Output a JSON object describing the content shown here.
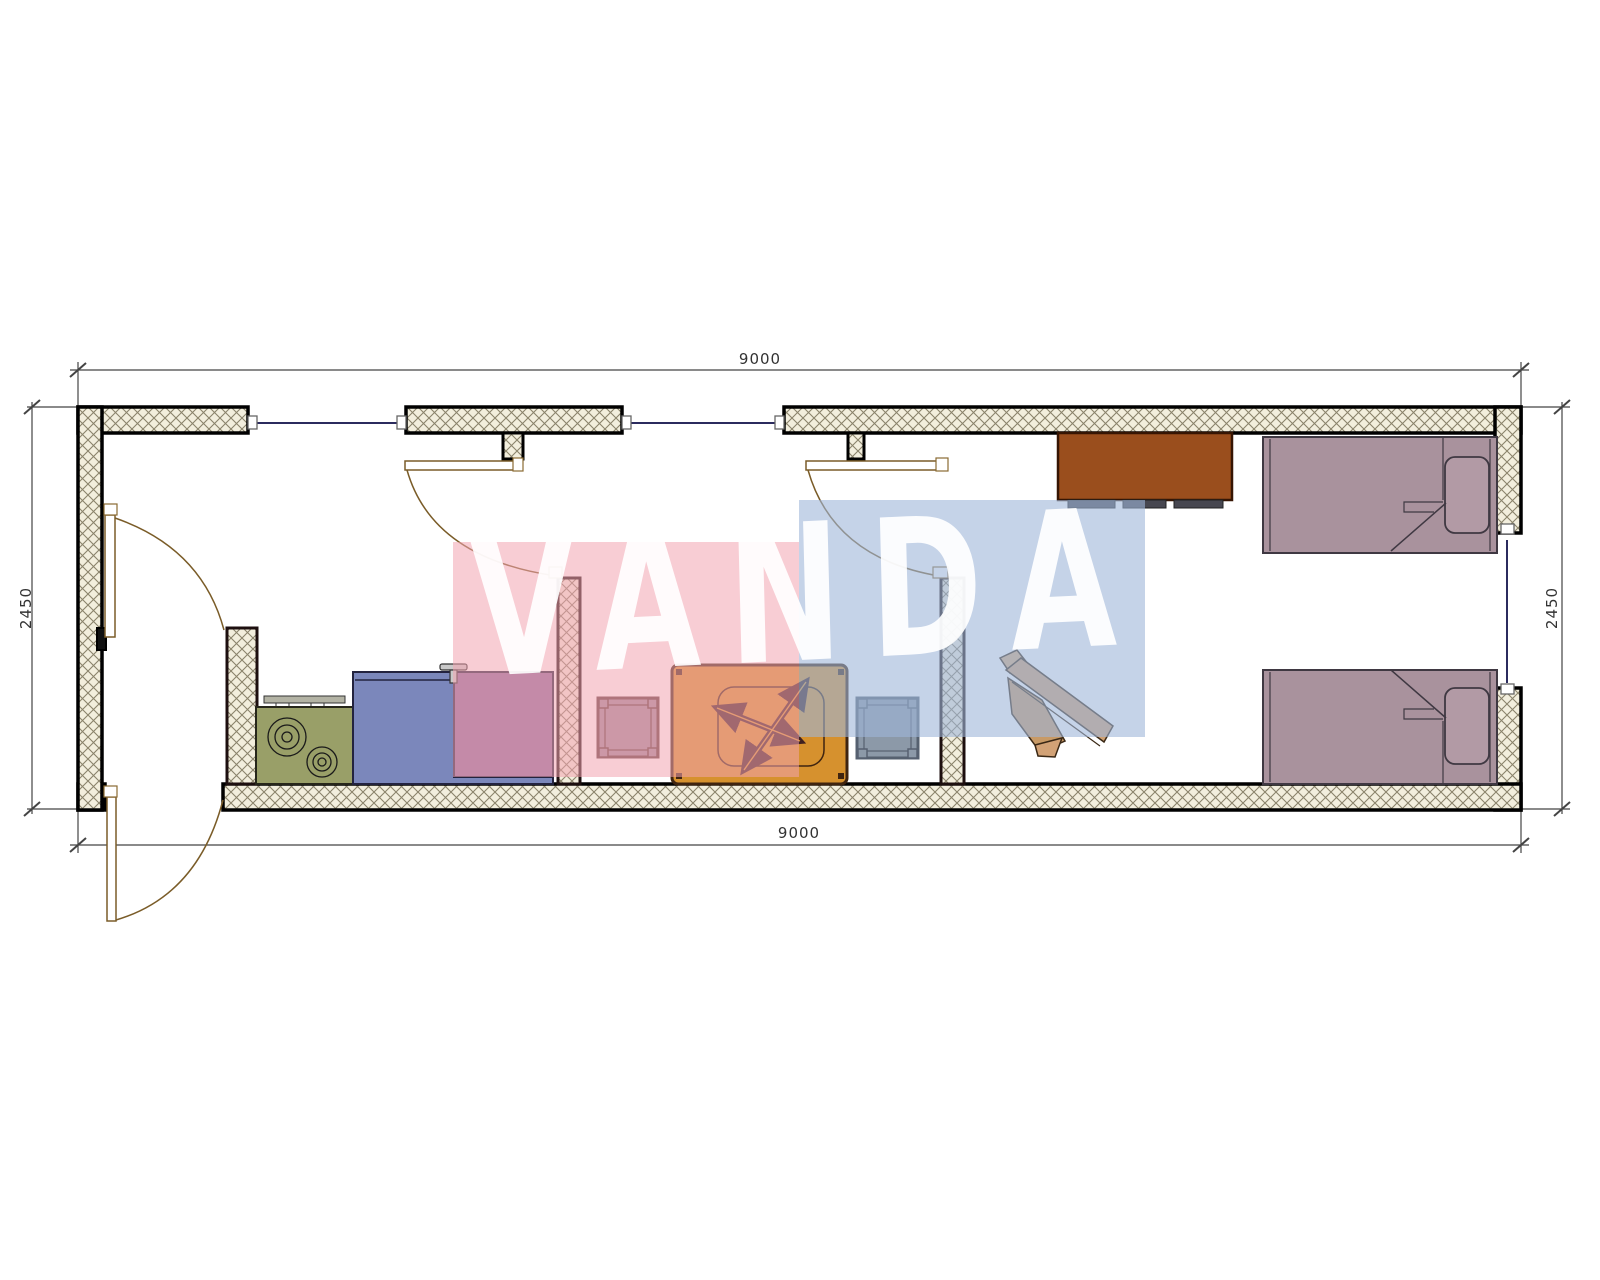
{
  "page": {
    "type": "architectural floor plan drawing",
    "background": "#ffffff",
    "plan_overall_mm": {
      "width": "9000",
      "depth": "2450"
    }
  },
  "dimensions": {
    "top": "9000",
    "bottom": "9000",
    "left": "2450",
    "right": "2450"
  },
  "watermark": {
    "text": "VANDA",
    "pink_block": "#f2a4b0",
    "blue_block": "#9eb5d8",
    "letter_color": "#ffffff"
  },
  "palette": {
    "wall_hatch_fill": "#f2eedd",
    "wall_hatch_line": "#8a836b",
    "wall_border": "#000000",
    "window_line": "#2b2b5e",
    "door_line": "#7a5c28",
    "dimension_line": "#444444"
  },
  "furniture": [
    {
      "name": "stove",
      "color": "#999f68"
    },
    {
      "name": "kitchen-counter",
      "color": "#7b87bb"
    },
    {
      "name": "sink-cabinet",
      "color": "#8d6a9e"
    },
    {
      "name": "stool-left",
      "frame": "#5d3a3a",
      "fill": "#9d8b9b"
    },
    {
      "name": "table-with-fan",
      "color": "#d6912e",
      "fan": "#3f2020"
    },
    {
      "name": "stool-right",
      "frame": "#566170",
      "fill": "#8c99a8"
    },
    {
      "name": "wardrobe",
      "color": "#9a4e1d"
    },
    {
      "name": "bed-top",
      "color": "#a9929d"
    },
    {
      "name": "bed-bottom",
      "color": "#a9929d"
    },
    {
      "name": "desk-chair",
      "color": "#d0a070"
    }
  ]
}
